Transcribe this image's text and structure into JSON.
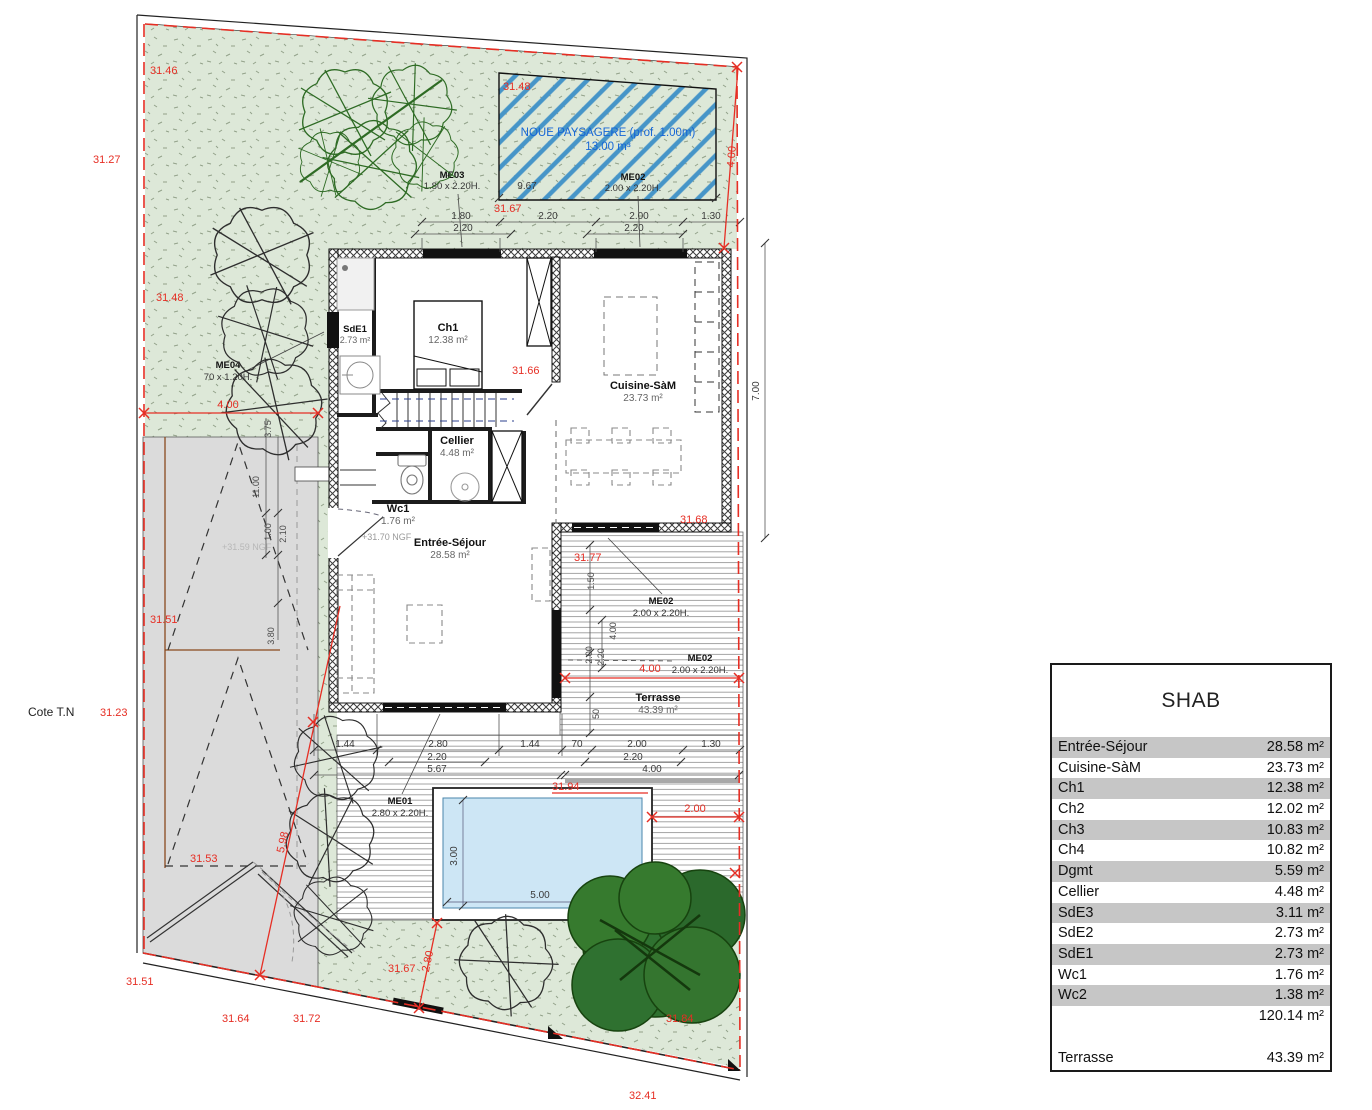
{
  "shab": {
    "title": "SHAB",
    "rows": [
      {
        "label": "Entrée-Séjour",
        "value": "28.58 m²"
      },
      {
        "label": "Cuisine-SàM",
        "value": "23.73 m²"
      },
      {
        "label": "Ch1",
        "value": "12.38 m²"
      },
      {
        "label": "Ch2",
        "value": "12.02 m²"
      },
      {
        "label": "Ch3",
        "value": "10.83 m²"
      },
      {
        "label": "Ch4",
        "value": "10.82 m²"
      },
      {
        "label": "Dgmt",
        "value": "5.59 m²"
      },
      {
        "label": "Cellier",
        "value": "4.48 m²"
      },
      {
        "label": "SdE3",
        "value": "3.11 m²"
      },
      {
        "label": "SdE2",
        "value": "2.73 m²"
      },
      {
        "label": "SdE1",
        "value": "2.73 m²"
      },
      {
        "label": "Wc1",
        "value": "1.76 m²"
      },
      {
        "label": "Wc2",
        "value": "1.38 m²"
      },
      {
        "label": "",
        "value": "120.14 m²"
      }
    ],
    "terrasse": {
      "label": "Terrasse",
      "value": "43.39 m²"
    }
  },
  "plan": {
    "noue": {
      "title": "NOUE PAYSAGERE (prof. 1.00m)",
      "volume": "13.00 m³",
      "width": "9.67"
    },
    "rooms": {
      "sde1": {
        "name": "SdE1",
        "area": "2.73 m²"
      },
      "ch1": {
        "name": "Ch1",
        "area": "12.38 m²"
      },
      "cellier": {
        "name": "Cellier",
        "area": "4.48 m²"
      },
      "wc1": {
        "name": "Wc1",
        "area": "1.76 m²"
      },
      "sejour": {
        "name": "Entrée-Séjour",
        "area": "28.58 m²"
      },
      "cuisine": {
        "name": "Cuisine-SàM",
        "area": "23.73 m²"
      },
      "terrasse": {
        "name": "Terrasse",
        "area": "43.39 m²"
      }
    },
    "menuiseries": {
      "me01": {
        "name": "ME01",
        "size": "2.80 x 2.20H."
      },
      "me02": {
        "name": "ME02",
        "size": "2.00 x 2.20H."
      },
      "me03": {
        "name": "ME03",
        "size": "1.80 x 2.20H."
      },
      "me04": {
        "name": "ME04",
        "size": "70 x 1.20H."
      }
    },
    "levels": {
      "nw": "31.46",
      "west_margin": "31.27",
      "west": "31.48",
      "noue": "31.48",
      "top": "31.67",
      "hall": "31.66",
      "kitchen": "31.68",
      "terrace_n": "31.77",
      "pool_n": "31.94",
      "tree_se": "31.84",
      "garden_s": "31.67",
      "drive": "31.51",
      "drive_s": "31.53",
      "sw": "31.51",
      "s1": "31.64",
      "s2": "31.72",
      "se": "32.41"
    },
    "cote_tn": {
      "label": "Cote T.N",
      "value": "31.23"
    },
    "ngf": {
      "entry": "+31.70 NGF",
      "drive": "+31.59 NGF"
    },
    "dims": {
      "top1": [
        "1.80",
        "2.20",
        "2.00",
        "1.30"
      ],
      "top2": [
        "2.20",
        "2.20"
      ],
      "bot1": [
        "1.44",
        "2.80",
        "1.44",
        "70",
        "2.00",
        "1.30"
      ],
      "bot2": [
        "2.20",
        "2.20"
      ],
      "bot3": [
        "5.67",
        "4.00"
      ],
      "drive": [
        "3.75",
        "11.00",
        "1.00",
        "2.10",
        "3.80"
      ],
      "terrace_v": [
        "1.50",
        "4.00",
        "2.00",
        "2.20",
        "50"
      ],
      "pool": {
        "w": "5.00",
        "h": "3.00"
      },
      "right": "7.00",
      "red": {
        "garden": "4.00",
        "ne": "4.00",
        "terrace": "4.00",
        "margin": "2.00",
        "diag": "5.98",
        "corner": "2.80"
      }
    }
  }
}
